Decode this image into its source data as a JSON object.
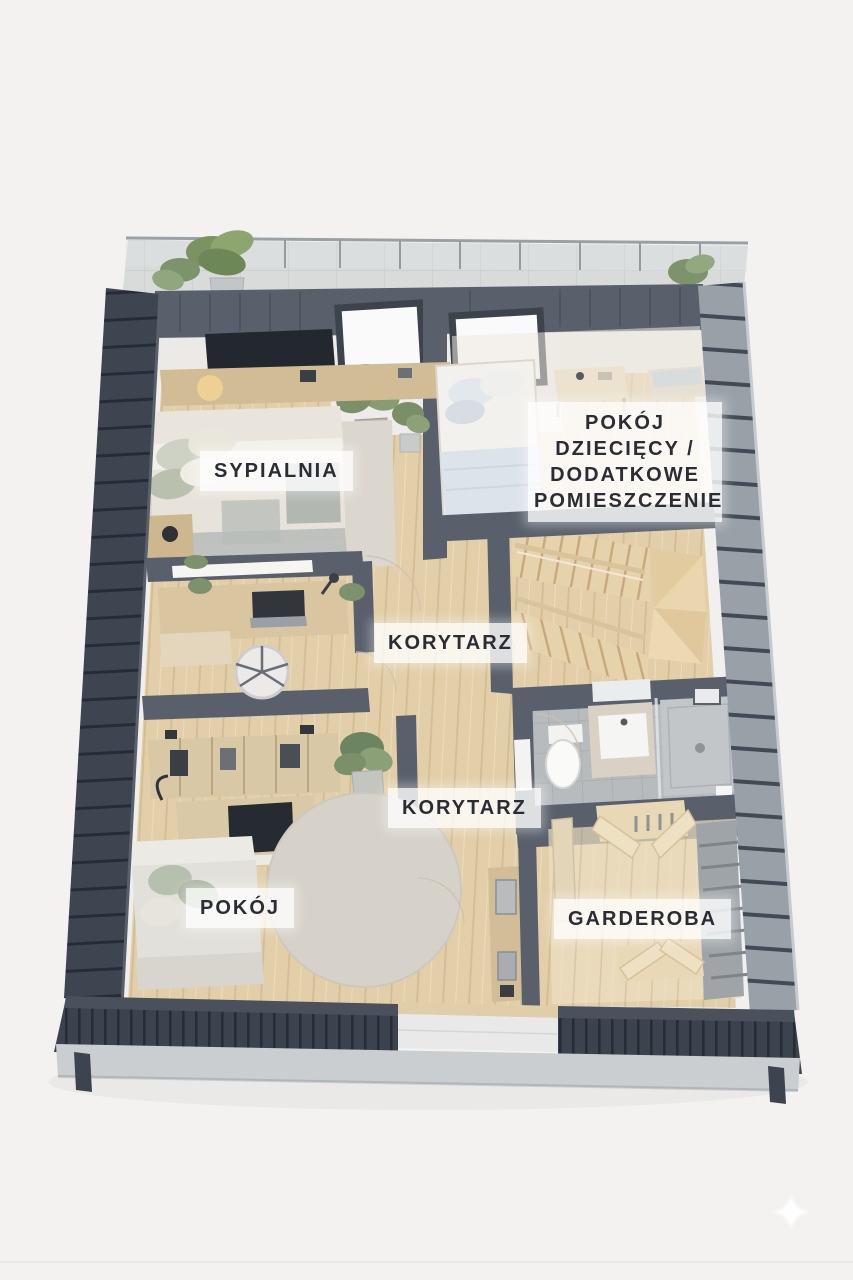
{
  "labels": {
    "bedroom": "SYPIALNIA",
    "kids_room": "POKÓJ\nDZIECIĘCY /\nDODATKOWE\nPOMIESZCZENIE",
    "corridor_upper": "KORYTARZ",
    "corridor_lower": "KORYTARZ",
    "room": "POKÓJ",
    "wardrobe": "GARDEROBA"
  },
  "icons": {
    "sparkle": "✦"
  },
  "colors": {
    "bg": "#f3f2f0",
    "label-text": "#2a2d33",
    "roof-dark": "#3e4551",
    "roof-rib": "#262c36",
    "roof-light": "#9aa0a8",
    "wall-dark": "#59606b",
    "wall-white": "#efeeeb",
    "rug": "#dbd7cf",
    "fascia": "#cbced0"
  }
}
